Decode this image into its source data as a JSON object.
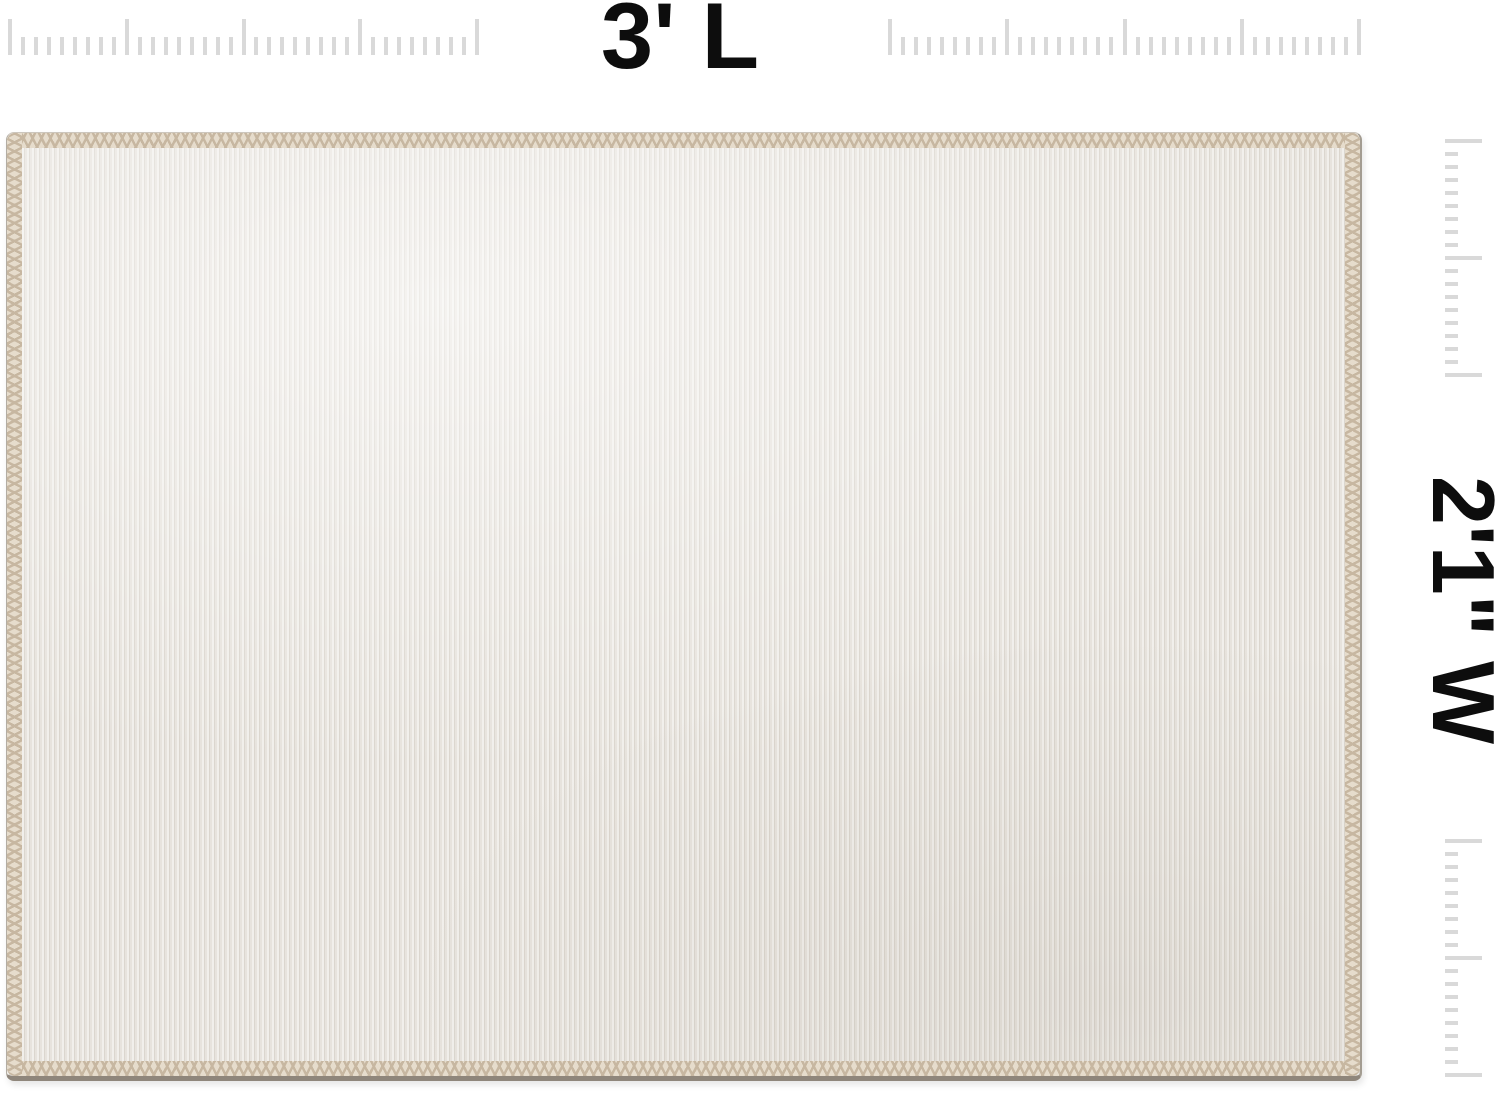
{
  "labels": {
    "length": "3' L",
    "width": "2'1\" W"
  },
  "colors": {
    "background": "#ffffff",
    "text": "#0d0d0d",
    "tick": "#d9d9d9",
    "fabric_base": "#e7e3dd",
    "fabric_rib_light": "#f1efeb",
    "fabric_rib_dark": "#dbd6ce",
    "stitch": "#c7b7a1",
    "stitch_base": "#e6dccc",
    "edge_line": "#8f867b"
  },
  "rulers": {
    "top": {
      "baseline_y": 55,
      "tick_width": 4,
      "major_len": 36,
      "minor_len": 18,
      "minor_per_major": 8,
      "segments": [
        {
          "start_x": 10,
          "end_x": 477,
          "majors": 5
        },
        {
          "start_x": 890,
          "end_x": 1359,
          "majors": 5
        }
      ]
    },
    "side": {
      "left_x": 1445,
      "tick_width": 4,
      "major_len": 37,
      "minor_len": 13,
      "minor_per_major": 8,
      "segments": [
        {
          "start_y": 141,
          "end_y": 375,
          "majors": 3
        },
        {
          "start_y": 841,
          "end_y": 1075,
          "majors": 3
        }
      ]
    }
  }
}
